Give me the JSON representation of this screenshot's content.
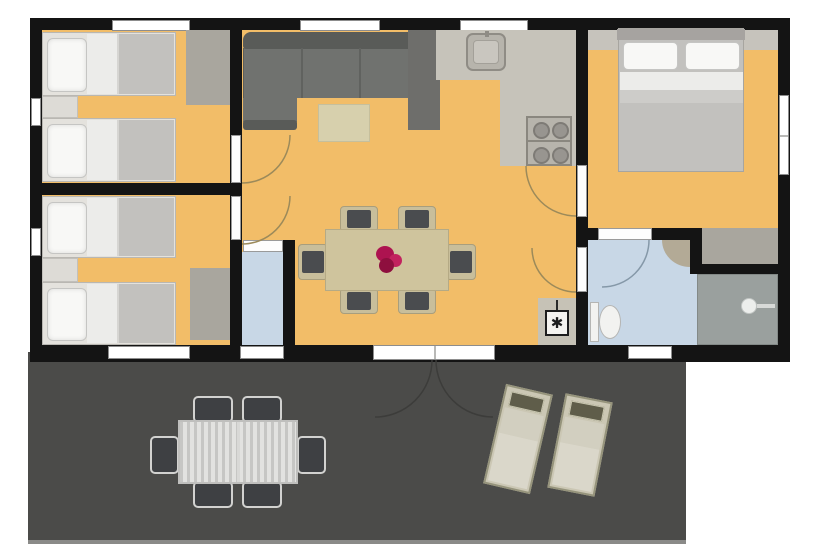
{
  "colors": {
    "wall": "#141414",
    "floor": "#f2bd68",
    "kitchen_floor": "#c6c3ba",
    "bath_floor": "#c8d7e6",
    "deck": "#4b4b49",
    "deck_edge": "#8a8a88",
    "unit_gray": "#a9a69e",
    "dark_unit": "#6e6e6b",
    "sofa": "#70726f",
    "sofa_dark": "#595b58",
    "rug": "#d7d0ad",
    "table": "#cfc49d",
    "chair_seat": "#4a4c4f",
    "chair_trim": "#c8be9b",
    "flower": "#ad1350",
    "bed_frame": "#e4e2dd",
    "pillow": "#f8f8f6",
    "sheet": "#ececea",
    "blanket": "#c2c1be",
    "headboard": "#a6a3a0",
    "counter": "#b7b4ac",
    "burner": "#989590",
    "toilet": "#f2f2f0",
    "shower": "#9aa09e",
    "outdoor_table": "#d8d8d6",
    "outdoor_chair": "#3e4043",
    "lounger_body": "#cbc7b4",
    "lounger_pad": "#dad7ca",
    "lounger_head": "#5f5d4a",
    "window": "#ffffff",
    "arc_indoor": "#9c8a5a",
    "arc_bath": "#8598a8",
    "arc_deck": "#3c3c3a"
  },
  "rooms": [
    {
      "id": "bedroom-1",
      "name": "Bedroom with two single beds (top left)"
    },
    {
      "id": "bedroom-2",
      "name": "Bedroom with two single beds (bottom left)"
    },
    {
      "id": "living-dining",
      "name": "Open living and dining room"
    },
    {
      "id": "kitchen",
      "name": "Kitchen corner"
    },
    {
      "id": "master-bedroom",
      "name": "Master bedroom with double bed"
    },
    {
      "id": "wc",
      "name": "Separate WC"
    },
    {
      "id": "bathroom",
      "name": "Bathroom with shower"
    },
    {
      "id": "terrace",
      "name": "Terrace deck with garden furniture"
    }
  ],
  "furniture": [
    "single bed x4",
    "nightstand x2",
    "wardrobe x3",
    "corner sofa",
    "rug",
    "dining table",
    "dining chair x6",
    "flower centerpiece",
    "kitchen sink",
    "stove with 4 burners",
    "tall cabinet",
    "boiler appliance",
    "double bed",
    "toilet x2",
    "corner basin",
    "shower",
    "outdoor table",
    "outdoor chair x6",
    "sun lounger x2"
  ],
  "symbols": {
    "boiler": "✱"
  }
}
